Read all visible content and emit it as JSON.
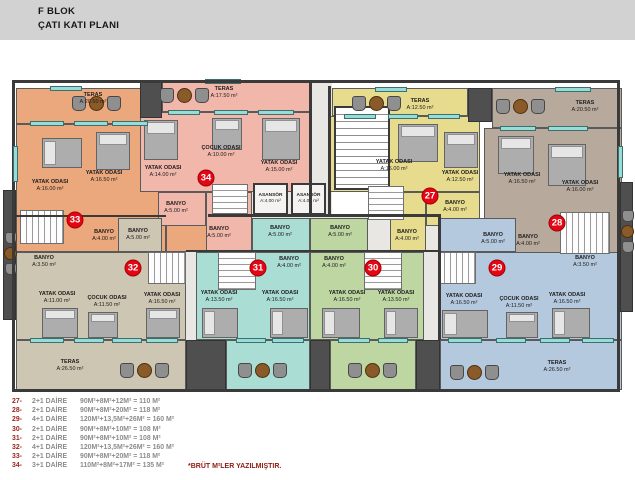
{
  "header": {
    "line1": "F BLOK",
    "line2": "ÇATI KATI PLANI"
  },
  "plan": {
    "unit_circles": [
      {
        "number": "33"
      },
      {
        "number": "34"
      },
      {
        "number": "27"
      },
      {
        "number": "28"
      },
      {
        "number": "32"
      },
      {
        "number": "31"
      },
      {
        "number": "30"
      },
      {
        "number": "29"
      }
    ],
    "rooms": [
      {
        "unit": "33",
        "name": "TERAS",
        "area": "A:20.50 m²"
      },
      {
        "unit": "33",
        "name": "YATAK ODASI",
        "area": "A:16.00 m²"
      },
      {
        "unit": "33",
        "name": "YATAK ODASI",
        "area": "A:16.50 m²"
      },
      {
        "unit": "34",
        "name": "BANYO",
        "area": "A:5.00 m²"
      },
      {
        "unit": "33",
        "name": "BANYO",
        "area": "A:4.00 m²"
      },
      {
        "unit": "34",
        "name": "TERAS",
        "area": "A:17.50 m²"
      },
      {
        "unit": "34",
        "name": "ÇOCUK ODASI",
        "area": "A:10.00 m²"
      },
      {
        "unit": "34",
        "name": "YATAK ODASI",
        "area": "A:14.00 m²"
      },
      {
        "unit": "34",
        "name": "YATAK ODASI",
        "area": "A:15.00 m²"
      },
      {
        "unit": "34",
        "name": "BANYO",
        "area": "A:5.00 m²"
      },
      {
        "unit": "core",
        "name": "ASANSÖR",
        "area": "A:4.00 m²"
      },
      {
        "unit": "core",
        "name": "ASANSÖR",
        "area": "A:4.00 m²"
      },
      {
        "unit": "27",
        "name": "TERAS",
        "area": "A:12.50 m²"
      },
      {
        "unit": "27",
        "name": "YATAK ODASI",
        "area": "A:16.00 m²"
      },
      {
        "unit": "27",
        "name": "YATAK ODASI",
        "area": "A:12.50 m²"
      },
      {
        "unit": "27",
        "name": "BANYO",
        "area": "A:4.00 m²"
      },
      {
        "unit": "27",
        "name": "BANYO",
        "area": "A:4.00 m²"
      },
      {
        "unit": "28",
        "name": "TERAS",
        "area": "A:20.50 m²"
      },
      {
        "unit": "28",
        "name": "YATAK ODASI",
        "area": "A:16.50 m²"
      },
      {
        "unit": "28",
        "name": "YATAK ODASI",
        "area": "A:16.00 m²"
      },
      {
        "unit": "28",
        "name": "BANYO",
        "area": "A:4.00 m²"
      },
      {
        "unit": "32",
        "name": "BANYO",
        "area": "A:5.00 m²"
      },
      {
        "unit": "32",
        "name": "BANYO",
        "area": "A:3.50 m²"
      },
      {
        "unit": "32",
        "name": "YATAK ODASI",
        "area": "A:11.00 m²"
      },
      {
        "unit": "32",
        "name": "ÇOCUK ODASI",
        "area": "A:11.50 m²"
      },
      {
        "unit": "32",
        "name": "YATAK ODASI",
        "area": "A:16.50 m²"
      },
      {
        "unit": "32",
        "name": "TERAS",
        "area": "A:26.50 m²"
      },
      {
        "unit": "31",
        "name": "BANYO",
        "area": "A:5.00 m²"
      },
      {
        "unit": "31",
        "name": "BANYO",
        "area": "A:4.00 m²"
      },
      {
        "unit": "31",
        "name": "YATAK ODASI",
        "area": "A:13.50 m²"
      },
      {
        "unit": "31",
        "name": "YATAK ODASI",
        "area": "A:16.50 m²"
      },
      {
        "unit": "30",
        "name": "BANYO",
        "area": "A:5.00 m²"
      },
      {
        "unit": "30",
        "name": "BANYO",
        "area": "A:4.00 m²"
      },
      {
        "unit": "30",
        "name": "YATAK ODASI",
        "area": "A:16.50 m²"
      },
      {
        "unit": "30",
        "name": "YATAK ODASI",
        "area": "A:13.50 m²"
      },
      {
        "unit": "29",
        "name": "BANYO",
        "area": "A:5.00 m²"
      },
      {
        "unit": "29",
        "name": "BANYO",
        "area": "A:3.50 m²"
      },
      {
        "unit": "29",
        "name": "YATAK ODASI",
        "area": "A:16.50 m²"
      },
      {
        "unit": "29",
        "name": "ÇOCUK ODASI",
        "area": "A:11.50 m²"
      },
      {
        "unit": "29",
        "name": "YATAK ODASI",
        "area": "A:16.50 m²"
      },
      {
        "unit": "29",
        "name": "TERAS",
        "area": "A:26.50 m²"
      }
    ]
  },
  "legend": {
    "rows": [
      {
        "num": "27-",
        "type": "2+1 DAİRE",
        "formula": "90M²+8M²+12M² = 110 M²"
      },
      {
        "num": "28-",
        "type": "2+1 DAİRE",
        "formula": "90M²+8M²+20M² = 118 M²"
      },
      {
        "num": "29-",
        "type": "4+1 DAİRE",
        "formula": "120M²+13,5M²+26M² = 160 M²"
      },
      {
        "num": "30-",
        "type": "2+1 DAİRE",
        "formula": "90M²+8M²+10M² = 108 M²"
      },
      {
        "num": "31-",
        "type": "2+1 DAİRE",
        "formula": "90M²+8M²+10M² = 108 M²"
      },
      {
        "num": "32-",
        "type": "4+1 DAİRE",
        "formula": "120M²+13,5M²+26M² = 160 M²"
      },
      {
        "num": "33-",
        "type": "2+1 DAİRE",
        "formula": "90M²+8M²+20M² = 118 M²"
      },
      {
        "num": "34-",
        "type": "3+1 DAİRE",
        "formula": "110M²+8M²+17M² = 135 M²"
      }
    ],
    "note": "*BRÜT M²LER YAZILMIŞTIR."
  },
  "colors": {
    "unit_27": "#e7db8e",
    "unit_28": "#b7aa9d",
    "unit_29": "#b5c9de",
    "unit_30": "#bed6a2",
    "unit_31": "#aaddd4",
    "unit_32": "#cdc6b2",
    "unit_33": "#eba87d",
    "unit_34": "#f2b7ab",
    "circle_red": "#e30613",
    "legend_number_red": "#9c241c",
    "note_red": "#8e1a12",
    "window_teal": "#98dcd8",
    "wall_dark": "#3a3a3a",
    "header_gray": "#d2d2d2"
  }
}
